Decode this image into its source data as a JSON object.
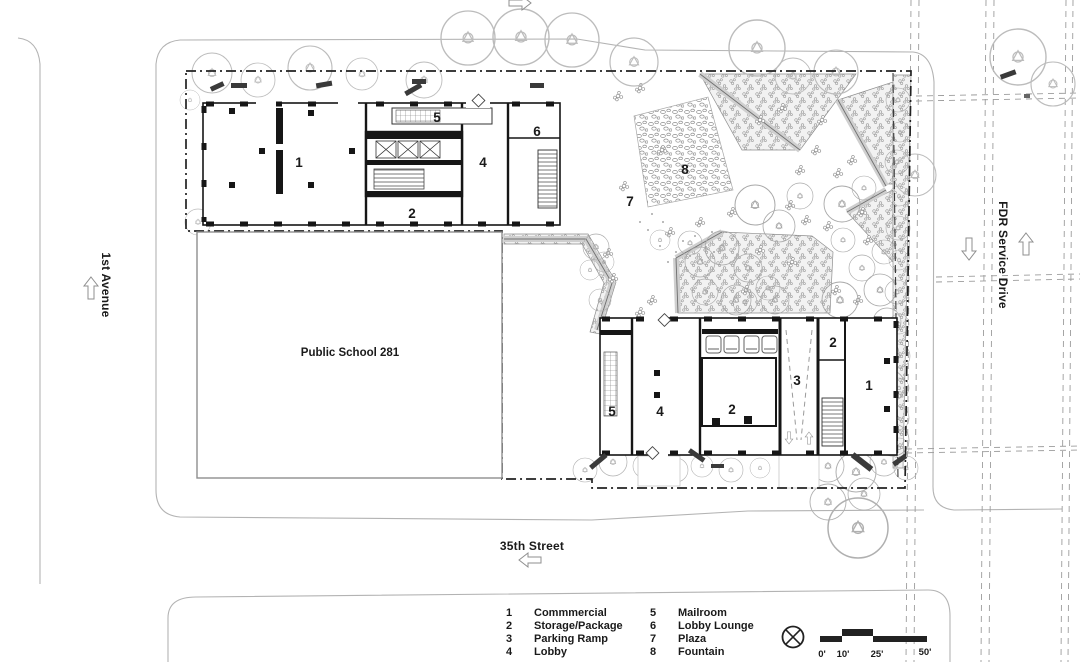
{
  "plan": {
    "school_label": "Public School 281",
    "streets": {
      "west": "1st Avenue",
      "south": "35th Street",
      "east": "FDR Service Drive"
    },
    "room_labels": {
      "north_building": [
        "1",
        "5",
        "4",
        "6",
        "2"
      ],
      "plaza": [
        "7",
        "8"
      ],
      "south_building": [
        "5",
        "4",
        "2",
        "3",
        "2",
        "1"
      ]
    }
  },
  "legend": {
    "items": [
      {
        "num": "1",
        "label": "Commmercial"
      },
      {
        "num": "2",
        "label": "Storage/Package"
      },
      {
        "num": "3",
        "label": "Parking Ramp"
      },
      {
        "num": "4",
        "label": "Lobby"
      },
      {
        "num": "5",
        "label": "Mailroom"
      },
      {
        "num": "6",
        "label": "Lobby Lounge"
      },
      {
        "num": "7",
        "label": "Plaza"
      },
      {
        "num": "8",
        "label": "Fountain"
      }
    ]
  },
  "scale_bar": {
    "ticks": [
      "0'",
      "10'",
      "25'",
      "50'"
    ]
  },
  "icons": {
    "north_indicator": "circle-cross-north-arrow-icon",
    "street_direction": "outline-arrow-icon"
  },
  "colors": {
    "ink": "#1a1a1a",
    "light_line": "#b3b3b3",
    "bed_fill": "#f2f2f2"
  }
}
